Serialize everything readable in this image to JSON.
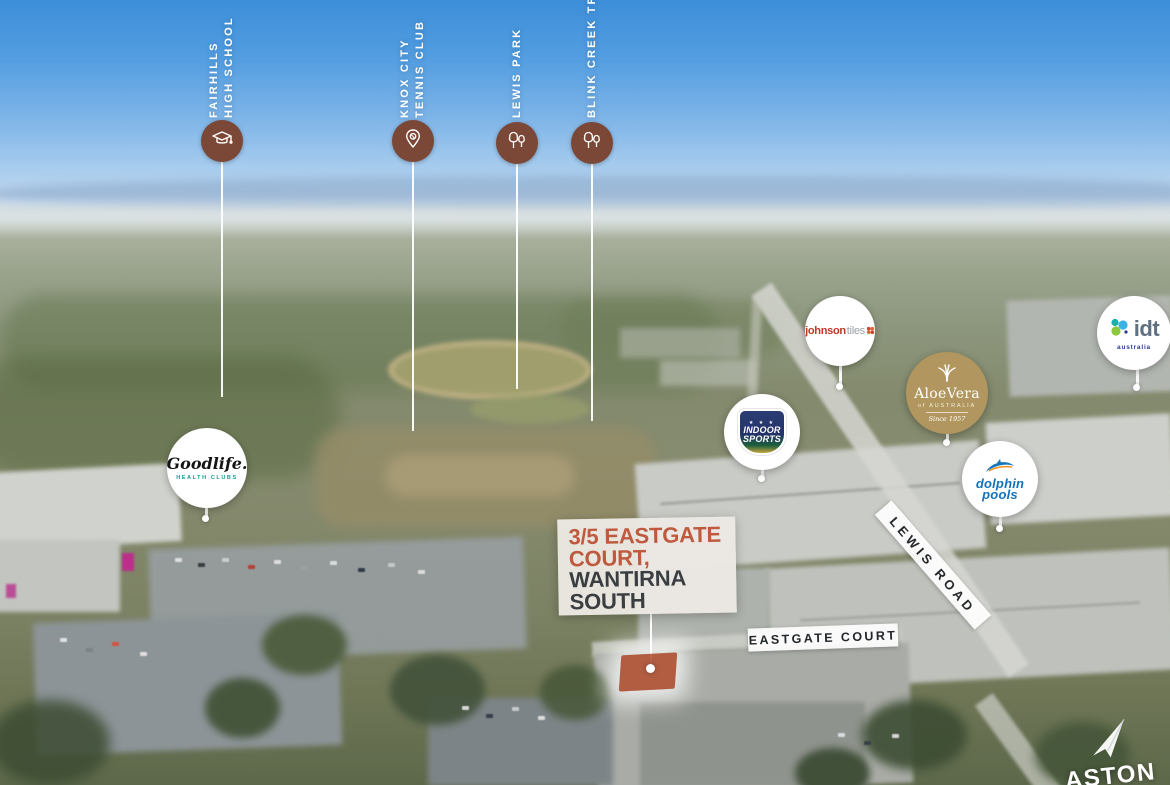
{
  "property_label": {
    "address_line1": "3/5 EASTGATE",
    "address_line2": "COURT,",
    "suburb_line1": "WANTIRNA",
    "suburb_line2": "SOUTH"
  },
  "poi_markers": [
    {
      "id": "fairhills-high-school",
      "icon": "graduation-cap",
      "lines": [
        "FAIRHILLS",
        "HIGH SCHOOL"
      ]
    },
    {
      "id": "knox-city-tennis-club",
      "icon": "map-pin",
      "lines": [
        "KNOX CITY",
        "TENNIS CLUB"
      ]
    },
    {
      "id": "lewis-park",
      "icon": "trees",
      "lines": [
        "LEWIS PARK"
      ]
    },
    {
      "id": "blink-creek-trail",
      "icon": "trees",
      "lines": [
        "BLINK CREEK TRAIL"
      ]
    }
  ],
  "business_bubbles": [
    {
      "id": "goodlife-health-clubs",
      "title": "Goodlife.",
      "subtitle": "HEALTH CLUBS"
    },
    {
      "id": "johnson-tiles",
      "title": "johnson",
      "title2": "tiles"
    },
    {
      "id": "aloe-vera-of-australia",
      "title": "AloeVera",
      "subtitle": "of AUSTRALIA",
      "tagline": "Since 1957"
    },
    {
      "id": "idt-australia",
      "title": "idt",
      "subtitle": "australia"
    },
    {
      "id": "indoor-sports",
      "stars": "★ ★ ★",
      "title_line1": "INDOOR",
      "title_line2": "SPORTS"
    },
    {
      "id": "dolphin-pools",
      "title_line1": "dolphin",
      "title_line2": "pools"
    }
  ],
  "road_labels": [
    {
      "id": "eastgate-court",
      "text": "EASTGATE COURT"
    },
    {
      "id": "lewis-road",
      "text": "LEWIS ROAD"
    }
  ],
  "agency_watermark": {
    "text": "ASTON"
  },
  "colors": {
    "accent_rust": "#c05a3e",
    "marker_brown": "#7b4736",
    "charcoal": "#3a3e41",
    "sky_top": "#3c8ed9"
  }
}
